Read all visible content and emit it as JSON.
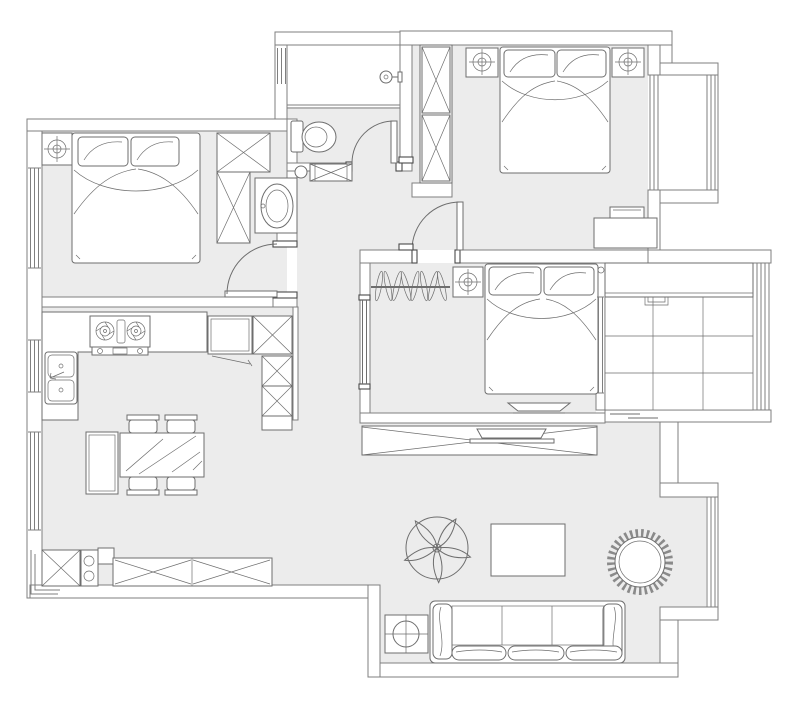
{
  "meta": {
    "description": "apartment-floor-plan"
  },
  "colors": {
    "floor": "#ececec",
    "wall_fill": "#ffffff",
    "line": "#7f7f7f",
    "line_secondary": "#6e6e6e",
    "line_dark": "#4a4a4a",
    "background": "#ffffff"
  },
  "rooms": [
    {
      "name": "bedroom-left",
      "furniture": [
        "double-bed",
        "pillows",
        "nightstand",
        "ceiling-lamp-symbol",
        "wardrobe-x-units",
        "wash-basin",
        "swing-door"
      ]
    },
    {
      "name": "bathroom",
      "furniture": [
        "shower-area",
        "shower-head",
        "toilet",
        "low-cabinet",
        "swing-door",
        "window"
      ]
    },
    {
      "name": "bedroom-master",
      "furniture": [
        "double-bed",
        "pillows",
        "nightstand-left",
        "nightstand-right",
        "ceiling-lamp-symbols",
        "wardrobe-x-units",
        "desk",
        "laptop",
        "bay-window",
        "swing-door"
      ]
    },
    {
      "name": "bedroom-middle",
      "furniture": [
        "double-bed",
        "pillows",
        "nightstand",
        "ceiling-lamp-symbol",
        "clothes-hanging-rail",
        "tv-shelf",
        "sliding-door",
        "window-to-balcony"
      ]
    },
    {
      "name": "kitchen",
      "furniture": [
        "l-counter",
        "gas-stove-2-burner",
        "double-bowl-sink",
        "fridge",
        "x-cabinet",
        "pantry-column",
        "window"
      ]
    },
    {
      "name": "dining",
      "furniture": [
        "glass-dining-table",
        "chairs-x4",
        "sideboard",
        "window"
      ]
    },
    {
      "name": "living",
      "furniture": [
        "sofa-3-seat",
        "side-table",
        "coffee-table",
        "pinwheel-fan-symbol",
        "round-rattan-chair",
        "tv-cabinet",
        "tv",
        "shoe-cabinet-x",
        "long-x-cabinet",
        "corner-window"
      ]
    },
    {
      "name": "balcony",
      "furniture": [
        "storage-counter",
        "floor-tile-grid",
        "window-wall"
      ]
    }
  ],
  "symbols": {
    "x_box": "cabinet-or-wardrobe",
    "crosshair_circle": "ceiling-lamp",
    "double_parallel_lines": "window-glazing",
    "quarter_arc": "door-swing"
  }
}
